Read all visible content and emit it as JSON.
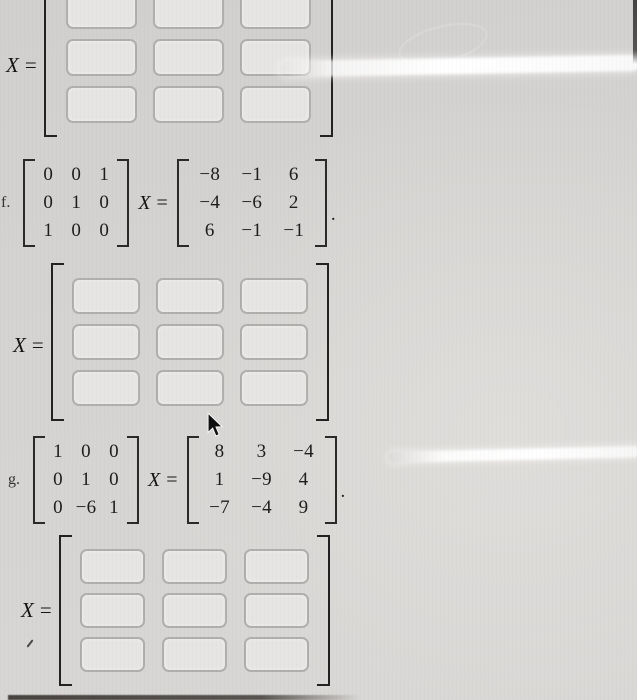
{
  "colors": {
    "background": "#d5d3d1",
    "ink": "#1d1d1d",
    "box_fill": "#e6e5e3",
    "box_border": "#b1afad",
    "glare": "#ffffff"
  },
  "symbols": {
    "x": "X",
    "equals": "="
  },
  "problems": [
    {
      "label": "f.",
      "lhs": [
        [
          "0",
          "0",
          "1"
        ],
        [
          "0",
          "1",
          "0"
        ],
        [
          "1",
          "0",
          "0"
        ]
      ],
      "rhs": [
        [
          "−8",
          "−1",
          "6"
        ],
        [
          "−4",
          "−6",
          "2"
        ],
        [
          "6",
          "−1",
          "−1"
        ]
      ],
      "period": "."
    },
    {
      "label": "g.",
      "lhs": [
        [
          "1",
          "0",
          "0"
        ],
        [
          "0",
          "1",
          "0"
        ],
        [
          "0",
          "−6",
          "1"
        ]
      ],
      "rhs": [
        [
          "8",
          "3",
          "−4"
        ],
        [
          "1",
          "−9",
          "4"
        ],
        [
          "−7",
          "−4",
          "9"
        ]
      ],
      "period": "."
    }
  ],
  "answers": {
    "count": 3,
    "rows": 3,
    "cols": 3
  }
}
